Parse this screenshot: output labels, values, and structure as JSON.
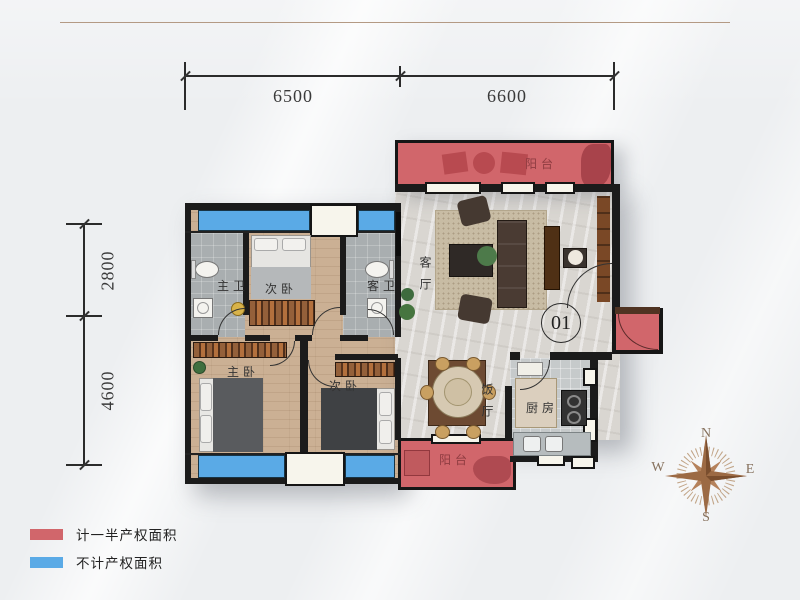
{
  "dimensions": {
    "top": [
      "6500",
      "6600"
    ],
    "left": [
      "2800",
      "4600"
    ]
  },
  "unit": {
    "number": "01"
  },
  "rooms": {
    "balcony_top": "阳台",
    "living_room": "客厅",
    "master_bath": "主卫",
    "second_bedroom_top": "次卧",
    "guest_bath": "客卫",
    "master_bedroom": "主卧",
    "second_bedroom_bottom": "次卧",
    "dining_room": "饭厅",
    "kitchen": "厨房",
    "balcony_bottom": "阳台"
  },
  "compass": {
    "north": "N",
    "east": "E",
    "south": "S",
    "west": "W"
  },
  "legend": {
    "items": [
      {
        "color": "#d1666b",
        "label": "计一半产权面积"
      },
      {
        "color": "#5aaae6",
        "label": "不计产权面积"
      }
    ]
  }
}
